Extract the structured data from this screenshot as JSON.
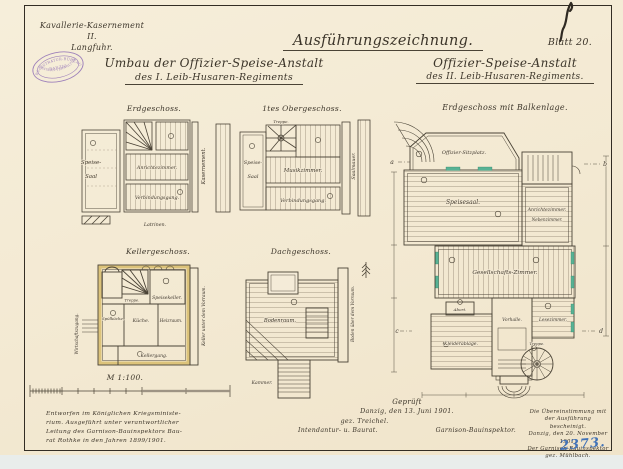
{
  "header": {
    "corner_line1": "Kavallerie-Kasernement II.",
    "corner_line2": "Langfuhr.",
    "main_title": "Ausführungszeichnung.",
    "sheet_label": "Blatt 20.",
    "left_title_line1": "Umbau der Offizier-Speise-Anstalt",
    "left_title_line2": "des I. Leib-Husaren-Regiments",
    "right_title_line1": "Offizier-Speise-Anstalt",
    "right_title_line2": "des II. Leib-Husaren-Regiments."
  },
  "stamp": {
    "arc_top": "REGISTRATUR-BÜREAU",
    "middle": "DANZIG",
    "arc_bottom": "GARNISON-VERWALTUNG",
    "color": "#8f6fb5"
  },
  "plans": {
    "erdgeschoss": {
      "title": "Erdgeschoss.",
      "room_speise": "Speise-",
      "room_saal": "Saal",
      "room_anrichte": "Anrichtezimmer.",
      "room_gang": "Verbindungsgang.",
      "label_right": "Kasernement.",
      "label_bottom": "Latrinen."
    },
    "obergeschoss": {
      "title": "1tes Obergeschoss.",
      "room_treppe": "Treppe.",
      "room_speise": "Speise-",
      "room_saal": "Saal",
      "room_musik": "Musikzimmer.",
      "room_gang": "Verbindungsgang.",
      "label_right": "Saalmauer."
    },
    "kellergeschoss": {
      "title": "Kellergeschoss.",
      "room_treppe": "Treppe.",
      "room_speisekeller": "Speisekeller.",
      "room_kueche": "Küche.",
      "room_spuele": "Spülküche.",
      "room_heiz": "Heizraum.",
      "room_gang": "Kellergang.",
      "label_left": "Wirtschaftszugang.",
      "label_right": "Keller unter dem Vorraum."
    },
    "dachgeschoss": {
      "title": "Dachgeschoss.",
      "room_boden": "Bodenraum.",
      "room_kammer": "Kammer.",
      "label_right": "Boden über dem Vorraum."
    },
    "balkenlage": {
      "title": "Erdgeschoss mit Balkenlage.",
      "room_sitzplatz": "Offizier-Sitzplatz.",
      "room_speisesaal": "Speisesaal.",
      "room_anrichte": "Anrichtezimmer.",
      "room_neben": "Nebenzimmer.",
      "room_gesellschaft": "Gesellschafts-Zimmer.",
      "room_abort": "Abort.",
      "room_kleider": "Kleiderablage.",
      "room_vorhalle": "Vorhalle.",
      "room_lese": "Lesezimmer.",
      "room_treppe": "Treppe.",
      "marker_a": "a",
      "marker_b": "b",
      "marker_c": "c",
      "marker_d": "d"
    }
  },
  "scale": {
    "label": "M 1:100."
  },
  "footer": {
    "left_note": [
      "Entworfen im Königlichen Kriegsministe-",
      "rium. Ausgeführt unter verantwortlicher",
      "Leitung des Garnison-Bauinspektors Bau-",
      "rat Rothke in den Jahren 1899/1901."
    ],
    "approval": {
      "line1": "Geprüft",
      "line2": "Danzig, den 13. Juni 1901.",
      "sig_left": "gez. Treichel.",
      "sig_right": "gez. Walther.",
      "role_left": "Intendantur- u. Baurat.",
      "role_right": "Garnison-Bauinspektor."
    },
    "certification": [
      "Die Übereinstimmung mit",
      "der Ausführung bescheinigt.",
      "Danzig, den 20. November 1901.",
      "Der Garnison-Bauinspektor",
      "gez. Mühlbach."
    ],
    "archive_number": "2373."
  },
  "colors": {
    "paper": "#f3e9d4",
    "ink": "#3e372b",
    "stamp_purple": "#8f6fb5",
    "blue_ink": "#4273b8",
    "beam_green": "#57b295",
    "wall_yellow": "#dcc37a"
  }
}
